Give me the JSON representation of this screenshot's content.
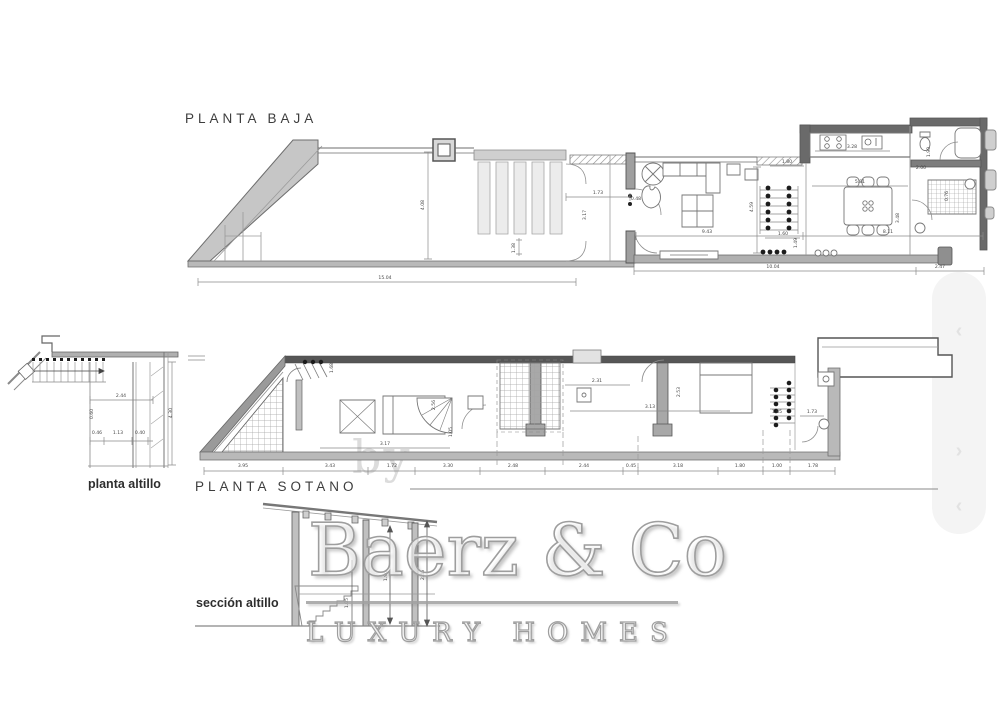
{
  "labels": {
    "planta_baja": "PLANTA BAJA",
    "planta_sotano": "PLANTA SOTANO",
    "planta_altillo": "planta altillo",
    "seccion_altillo": "sección altillo"
  },
  "watermark": {
    "prefix": "by",
    "brand": "Baerz & Co",
    "tagline": "LUXURY HOMES"
  },
  "scroll_strip": {
    "chevrons": [
      {
        "glyph": "‹",
        "y": 320
      },
      {
        "glyph": "›",
        "y": 440
      },
      {
        "glyph": "‹",
        "y": 495
      }
    ]
  },
  "colors": {
    "line": "#6e6e6e",
    "wall_fill": "#c2c2c2",
    "dark_wall": "#5a5a5a",
    "dim_text": "#474747",
    "title_text": "#3d3d3d",
    "watermark_gray": "#9e9e9e",
    "strip_bg": "#f4f4f4"
  },
  "dim_labels": {
    "baja": [
      {
        "t": "15.04",
        "x": 385,
        "y": 279
      },
      {
        "t": "10.04",
        "x": 773,
        "y": 268
      },
      {
        "t": "2.47",
        "x": 940,
        "y": 268
      },
      {
        "t": "1.73",
        "x": 598,
        "y": 194
      },
      {
        "t": "0.48",
        "x": 636,
        "y": 200
      },
      {
        "t": "3.17",
        "x": 586,
        "y": 215,
        "rot": 1
      },
      {
        "t": "4.08",
        "x": 424,
        "y": 205,
        "rot": 1
      },
      {
        "t": "1.38",
        "x": 515,
        "y": 248,
        "rot": 1
      },
      {
        "t": "4.59",
        "x": 753,
        "y": 207,
        "rot": 1
      },
      {
        "t": "9.43",
        "x": 707,
        "y": 233
      },
      {
        "t": "8.11",
        "x": 888,
        "y": 233
      },
      {
        "t": "1.80",
        "x": 787,
        "y": 163
      },
      {
        "t": "3.28",
        "x": 852,
        "y": 148
      },
      {
        "t": "1.90",
        "x": 930,
        "y": 152,
        "rot": 1
      },
      {
        "t": "2.00",
        "x": 921,
        "y": 169
      },
      {
        "t": "5.81",
        "x": 860,
        "y": 183
      },
      {
        "t": "3.48",
        "x": 899,
        "y": 218,
        "rot": 1
      },
      {
        "t": "1.60",
        "x": 783,
        "y": 235
      },
      {
        "t": "1.49",
        "x": 797,
        "y": 243,
        "rot": 1
      },
      {
        "t": "0.76",
        "x": 948,
        "y": 196,
        "rot": 1
      }
    ],
    "sotano": [
      {
        "t": "3.95",
        "x": 243,
        "y": 467
      },
      {
        "t": "3.43",
        "x": 330,
        "y": 467
      },
      {
        "t": "1.72",
        "x": 392,
        "y": 467
      },
      {
        "t": "3.30",
        "x": 448,
        "y": 467
      },
      {
        "t": "2.48",
        "x": 513,
        "y": 467
      },
      {
        "t": "2.44",
        "x": 584,
        "y": 467
      },
      {
        "t": "0.45",
        "x": 631,
        "y": 467
      },
      {
        "t": "3.18",
        "x": 678,
        "y": 467
      },
      {
        "t": "1.80",
        "x": 740,
        "y": 467
      },
      {
        "t": "1.00",
        "x": 777,
        "y": 467
      },
      {
        "t": "1.78",
        "x": 813,
        "y": 467
      },
      {
        "t": "1.68",
        "x": 333,
        "y": 368,
        "rot": 1
      },
      {
        "t": "3.17",
        "x": 385,
        "y": 445
      },
      {
        "t": "1.05",
        "x": 452,
        "y": 432,
        "rot": 1
      },
      {
        "t": "2.56",
        "x": 435,
        "y": 405,
        "rot": 1
      },
      {
        "t": "2.31",
        "x": 597,
        "y": 382
      },
      {
        "t": "3.13",
        "x": 650,
        "y": 408
      },
      {
        "t": "2.53",
        "x": 680,
        "y": 392,
        "rot": 1
      },
      {
        "t": "1.85",
        "x": 777,
        "y": 413
      },
      {
        "t": "1.73",
        "x": 812,
        "y": 413
      }
    ],
    "altillo": [
      {
        "t": "2.44",
        "x": 121,
        "y": 397
      },
      {
        "t": "4.30",
        "x": 172,
        "y": 413,
        "rot": 1
      },
      {
        "t": "0.46",
        "x": 97,
        "y": 434
      },
      {
        "t": "1.13",
        "x": 118,
        "y": 434
      },
      {
        "t": "0.40",
        "x": 140,
        "y": 434
      },
      {
        "t": "0.60",
        "x": 93,
        "y": 414,
        "rot": 1
      }
    ],
    "seccion": [
      {
        "t": "1.96",
        "x": 387,
        "y": 576,
        "rot": 1
      },
      {
        "t": "2.46",
        "x": 424,
        "y": 575,
        "rot": 1
      },
      {
        "t": "1.05",
        "x": 348,
        "y": 603,
        "rot": 1
      }
    ]
  }
}
